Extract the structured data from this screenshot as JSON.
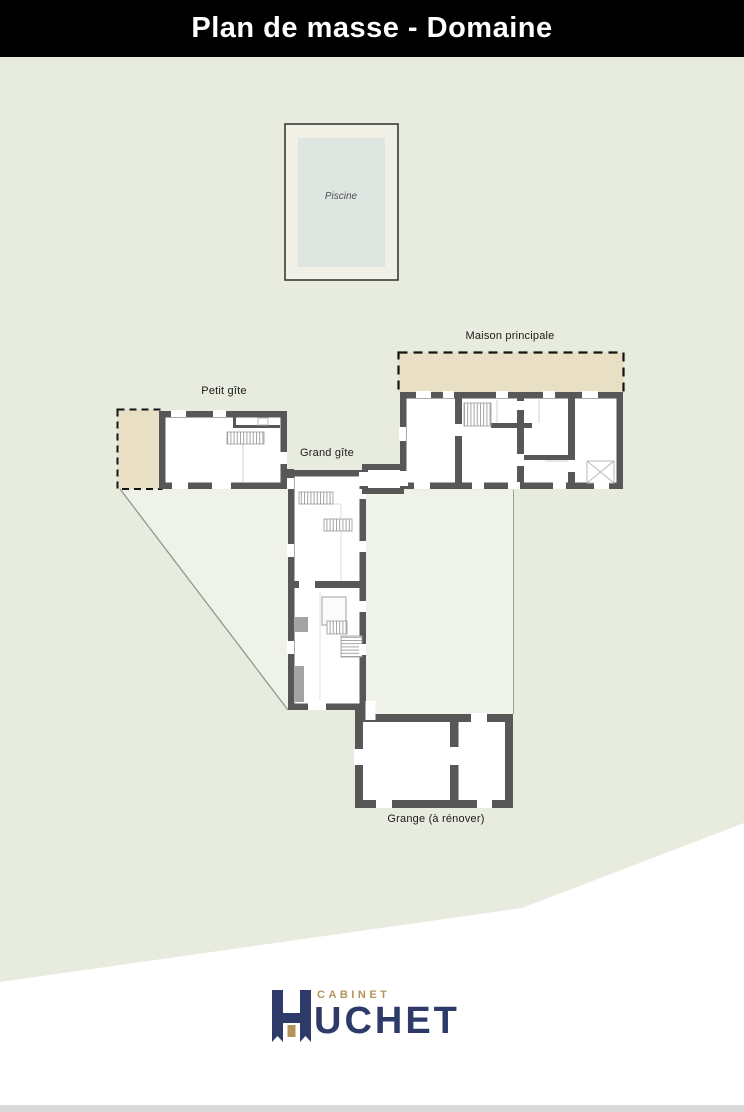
{
  "header": {
    "title": "Plan de masse - Domaine"
  },
  "plan": {
    "labels": {
      "piscine": "Piscine",
      "maison_principale": "Maison principale",
      "petit_gite": "Petit gîte",
      "grand_gite": "Grand gîte",
      "grange": "Grange (à rénover)"
    },
    "colors": {
      "ground": "#e7ecdf",
      "parcel_light": "#eff2e9",
      "wall": "#575757",
      "terrace": "#e9dfc4",
      "pool_deck": "#f1f0e7",
      "pool_water": "#dee6e1",
      "boundary_line": "#8e988c"
    }
  },
  "footer": {
    "brand_top": "CABINET",
    "brand_name": "HUCHET",
    "brand_name_rest": "UCHET",
    "brand_navy": "#2e3b69",
    "brand_gold": "#b3945a"
  }
}
